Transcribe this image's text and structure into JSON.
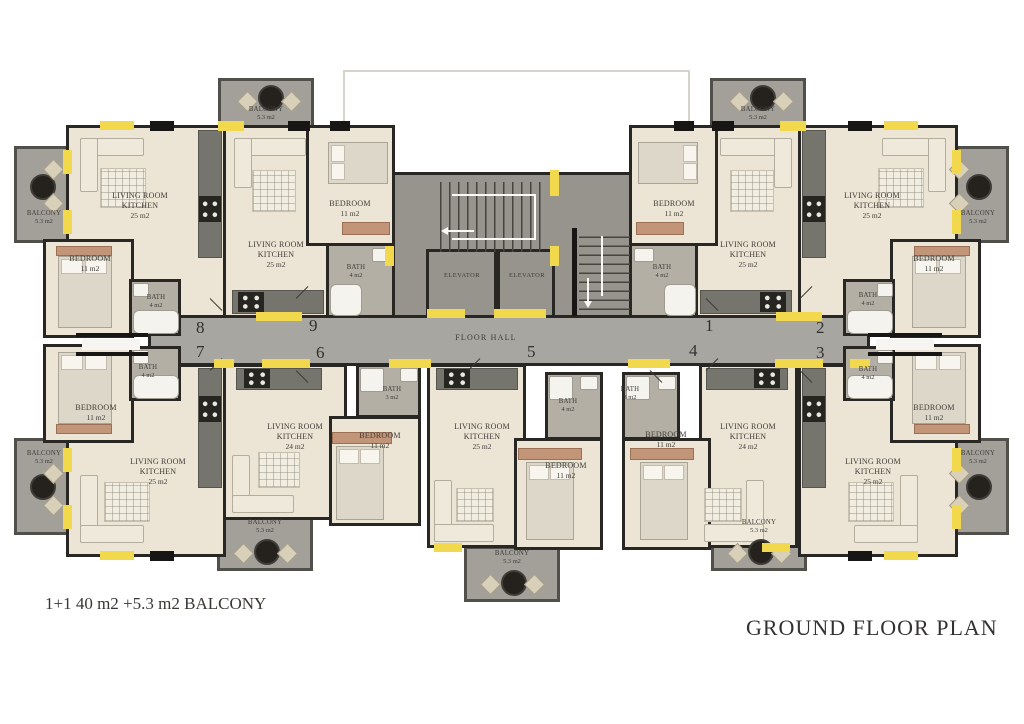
{
  "title": "GROUND FLOOR PLAN",
  "caption": "1+1 40 m2 +5.3 m2 BALCONY",
  "core": {
    "floor_hall": "FLOOR HALL",
    "elevator_1": "ELEVATOR",
    "elevator_2": "ELEVATOR"
  },
  "unit_numbers": {
    "n1": "1",
    "n2": "2",
    "n3": "3",
    "n4": "4",
    "n5": "5",
    "n6": "6",
    "n7": "7",
    "n8": "8",
    "n9": "9"
  },
  "rooms": {
    "living_8": {
      "name": "LIVING ROOM KITCHEN",
      "area": "25 m2"
    },
    "living_9": {
      "name": "LIVING ROOM KITCHEN",
      "area": "25 m2"
    },
    "living_1": {
      "name": "LIVING ROOM KITCHEN",
      "area": "25 m2"
    },
    "living_2": {
      "name": "LIVING ROOM KITCHEN",
      "area": "25 m2"
    },
    "living_7": {
      "name": "LIVING ROOM KITCHEN",
      "area": "25 m2"
    },
    "living_6": {
      "name": "LIVING ROOM KITCHEN",
      "area": "24 m2"
    },
    "living_5": {
      "name": "LIVING ROOM KITCHEN",
      "area": "25 m2"
    },
    "living_4": {
      "name": "LIVING ROOM KITCHEN",
      "area": "24 m2"
    },
    "living_3": {
      "name": "LIVING ROOM KITCHEN",
      "area": "25 m2"
    },
    "bedroom_8": {
      "name": "BEDROOM",
      "area": "11 m2"
    },
    "bedroom_9": {
      "name": "BEDROOM",
      "area": "11 m2"
    },
    "bedroom_1": {
      "name": "BEDROOM",
      "area": "11 m2"
    },
    "bedroom_2": {
      "name": "BEDROOM",
      "area": "11 m2"
    },
    "bedroom_7": {
      "name": "BEDROOM",
      "area": "11 m2"
    },
    "bedroom_6": {
      "name": "BEDROOM",
      "area": "11 m2"
    },
    "bedroom_5": {
      "name": "BEDROOM",
      "area": "11 m2"
    },
    "bedroom_4": {
      "name": "BEDROOM",
      "area": "11 m2"
    },
    "bedroom_3": {
      "name": "BEDROOM",
      "area": "11 m2"
    },
    "bath_8": {
      "name": "BATH",
      "area": "4 m2"
    },
    "bath_9": {
      "name": "BATH",
      "area": "4 m2"
    },
    "bath_1": {
      "name": "BATH",
      "area": "4 m2"
    },
    "bath_2": {
      "name": "BATH",
      "area": "4 m2"
    },
    "bath_7": {
      "name": "BATH",
      "area": "4 m2"
    },
    "bath_6": {
      "name": "BATH",
      "area": "3 m2"
    },
    "bath_5": {
      "name": "BATH",
      "area": "4 m2"
    },
    "bath_4": {
      "name": "BATH",
      "area": "3 m2"
    },
    "bath_3": {
      "name": "BATH",
      "area": "4 m2"
    },
    "balcony_8": {
      "name": "BALCONY",
      "area": "5.3 m2"
    },
    "balcony_9": {
      "name": "BALCONY",
      "area": "5.3 m2"
    },
    "balcony_1": {
      "name": "BALCONY",
      "area": "5.3 m2"
    },
    "balcony_2": {
      "name": "BALCONY",
      "area": "5.3 m2"
    },
    "balcony_7": {
      "name": "BALCONY",
      "area": "5.3 m2"
    },
    "balcony_6": {
      "name": "BALCONY",
      "area": "5.3 m2"
    },
    "balcony_5": {
      "name": "BALCONY",
      "area": "5.3 m2"
    },
    "balcony_4": {
      "name": "BALCONY",
      "area": "5.3 m2"
    },
    "balcony_3": {
      "name": "BALCONY",
      "area": "5.3 m2"
    }
  },
  "colors": {
    "wall": "#282724",
    "floor": "#ece5d5",
    "bath_floor": "#b3afa5",
    "hall": "#a8a6a0",
    "balcony": "#a3a09a",
    "window_accent": "#f2d84d",
    "text": "#3e3c38"
  }
}
